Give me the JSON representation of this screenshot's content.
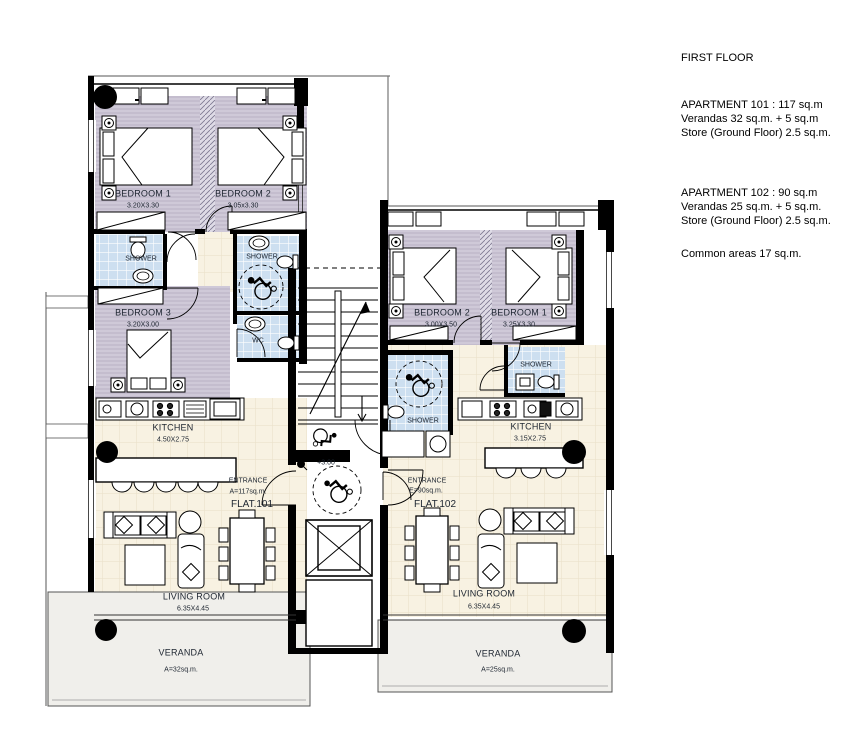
{
  "panel": {
    "title": "FIRST FLOOR",
    "apt101": [
      "APARTMENT 101 : 117 sq.m",
      "Verandas 32 sq.m. + 5 sq.m",
      "Store (Ground Floor) 2.5 sq.m."
    ],
    "apt102": [
      "APARTMENT 102 : 90 sq.m",
      "Verandas 25 sq.m. + 5 sq.m.",
      "Store (Ground Floor) 2.5 sq.m."
    ],
    "common": "Common areas 17 sq.m."
  },
  "flat101": {
    "bedroom1": {
      "name": "BEDROOM 1",
      "dims": "3.20X3.30"
    },
    "bedroom2": {
      "name": "BEDROOM 2",
      "dims": "3.05x3.30"
    },
    "bedroom3": {
      "name": "BEDROOM 3",
      "dims": "3.20X3.00"
    },
    "shower1": "SHOWER",
    "shower2": "SHOWER",
    "wc": "WC",
    "kitchen": {
      "name": "KITCHEN",
      "dims": "4.50X2.75"
    },
    "entrance": {
      "label": "ENTRANCE",
      "area": "A=117sq.m.",
      "flat": "FLAT.101"
    },
    "living": {
      "name": "LIVING ROOM",
      "dims": "6.35X4.45"
    },
    "veranda": {
      "name": "VERANDA",
      "area": "A=32sq.m."
    }
  },
  "flat102": {
    "bedroom1": {
      "name": "BEDROOM 1",
      "dims": "3.25X3.30"
    },
    "bedroom2": {
      "name": "BEDROOM 2",
      "dims": "3.00X3.50"
    },
    "shower1": "SHOWER",
    "shower2": "SHOWER",
    "kitchen": {
      "name": "KITCHEN",
      "dims": "3.15X2.75"
    },
    "entrance": {
      "label": "ENTRANCE",
      "area": "E=90sq.m.",
      "flat": "FLAT.102"
    },
    "living": {
      "name": "LIVING ROOM",
      "dims": "6.35X4.45"
    },
    "veranda": {
      "name": "VERANDA",
      "area": "A=25sq.m."
    }
  },
  "core": {
    "level": "+3.00"
  },
  "colors": {
    "bedroomFloor": "#cfc9d8",
    "tileFloor": "#cddff0",
    "livingFloor": "#f8f2e2",
    "verandaFloor": "#f0efeb",
    "wall": "#000000"
  }
}
